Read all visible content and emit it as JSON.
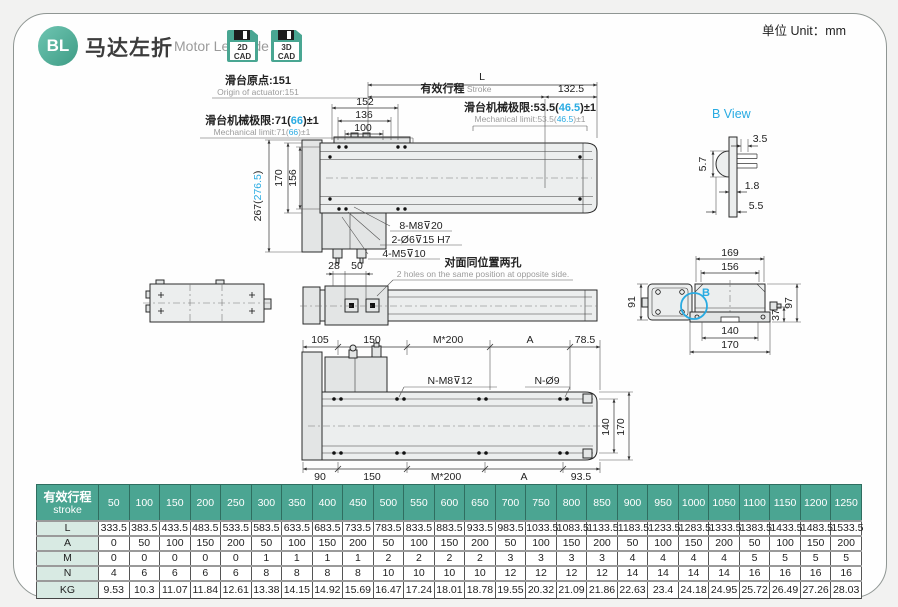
{
  "unit_label": "单位 Unit：mm",
  "header": {
    "badge": "BL",
    "title_cn": "马达左折",
    "title_en": "Motor Left Side",
    "cad2d_l1": "2D",
    "cad2d_l2": "CAD",
    "cad3d_l1": "3D",
    "cad3d_l2": "CAD"
  },
  "colors": {
    "accent_teal": "#4ba592",
    "accent_cyan": "#29abe2",
    "label_bg": "#d8eae3"
  },
  "topview": {
    "dim_l": "L",
    "stroke_cn": "有效行程",
    "stroke_en": " Stroke",
    "dim_1325": "132.5",
    "origin_cn": "滑台原点:151",
    "origin_en": "Origin of actuator:151",
    "limitL_cn_pre": "滑台机械极限:71(",
    "limitL_mid": "66",
    "limitL_post": ")±1",
    "limitL_en_pre": "Mechanical limit:71(",
    "limitR_cn_pre": "滑台机械极限:53.5(",
    "limitR_mid": "46.5",
    "limitR_post": ")±1",
    "limitR_en_pre": "Mechanical limit:53.5(",
    "dim_152": "152",
    "dim_136": "136",
    "dim_100": "100",
    "dim_267_pre": "267(",
    "dim_267_mid": "276.5",
    "dim_267_post": ")",
    "dim_170": "170",
    "dim_156": "156",
    "ann_m8": "8-M8⊽20",
    "ann_o6": "2-Ø6⊽15 H7",
    "ann_m5": "4-M5⊽10"
  },
  "sideview": {
    "dim_28": "28",
    "dim_50": "50",
    "note_cn": "对面同位置两孔",
    "note_en": "2 holes on the same position at opposite side."
  },
  "bview": {
    "title": "B View",
    "dim_35": "3.5",
    "dim_57": "5.7",
    "dim_18": "1.8",
    "dim_55": "5.5"
  },
  "endview": {
    "dim_169": "169",
    "dim_156": "156",
    "dim_91": "91",
    "dim_97": "97",
    "dim_37": "37",
    "dim_140": "140",
    "dim_170": "170",
    "b_label": "B"
  },
  "bottomview": {
    "top_dims": [
      "105",
      "150",
      "M*200",
      "A",
      "78.5"
    ],
    "bottom_dims": [
      "90",
      "150",
      "M*200",
      "A",
      "93.5"
    ],
    "ann_nm8": "N-M8⊽12",
    "ann_no9": "N-Ø9",
    "dim_140": "140",
    "dim_170": "170"
  },
  "table": {
    "header_cn": "有效行程",
    "header_en": "stroke",
    "strokes": [
      "50",
      "100",
      "150",
      "200",
      "250",
      "300",
      "350",
      "400",
      "450",
      "500",
      "550",
      "600",
      "650",
      "700",
      "750",
      "800",
      "850",
      "900",
      "950",
      "1000",
      "1050",
      "1100",
      "1150",
      "1200",
      "1250"
    ],
    "rows": [
      {
        "label": "L",
        "values": [
          "333.5",
          "383.5",
          "433.5",
          "483.5",
          "533.5",
          "583.5",
          "633.5",
          "683.5",
          "733.5",
          "783.5",
          "833.5",
          "883.5",
          "933.5",
          "983.5",
          "1033.5",
          "1083.5",
          "1133.5",
          "1183.5",
          "1233.5",
          "1283.5",
          "1333.5",
          "1383.5",
          "1433.5",
          "1483.5",
          "1533.5"
        ]
      },
      {
        "label": "A",
        "values": [
          "0",
          "50",
          "100",
          "150",
          "200",
          "50",
          "100",
          "150",
          "200",
          "50",
          "100",
          "150",
          "200",
          "50",
          "100",
          "150",
          "200",
          "50",
          "100",
          "150",
          "200",
          "50",
          "100",
          "150",
          "200"
        ]
      },
      {
        "label": "M",
        "values": [
          "0",
          "0",
          "0",
          "0",
          "0",
          "1",
          "1",
          "1",
          "1",
          "2",
          "2",
          "2",
          "2",
          "3",
          "3",
          "3",
          "3",
          "4",
          "4",
          "4",
          "4",
          "5",
          "5",
          "5",
          "5"
        ]
      },
      {
        "label": "N",
        "values": [
          "4",
          "6",
          "6",
          "6",
          "6",
          "8",
          "8",
          "8",
          "8",
          "10",
          "10",
          "10",
          "10",
          "12",
          "12",
          "12",
          "12",
          "14",
          "14",
          "14",
          "14",
          "16",
          "16",
          "16",
          "16"
        ]
      },
      {
        "label": "KG",
        "values": [
          "9.53",
          "10.3",
          "11.07",
          "11.84",
          "12.61",
          "13.38",
          "14.15",
          "14.92",
          "15.69",
          "16.47",
          "17.24",
          "18.01",
          "18.78",
          "19.55",
          "20.32",
          "21.09",
          "21.86",
          "22.63",
          "23.4",
          "24.18",
          "24.95",
          "25.72",
          "26.49",
          "27.26",
          "28.03"
        ]
      }
    ]
  }
}
